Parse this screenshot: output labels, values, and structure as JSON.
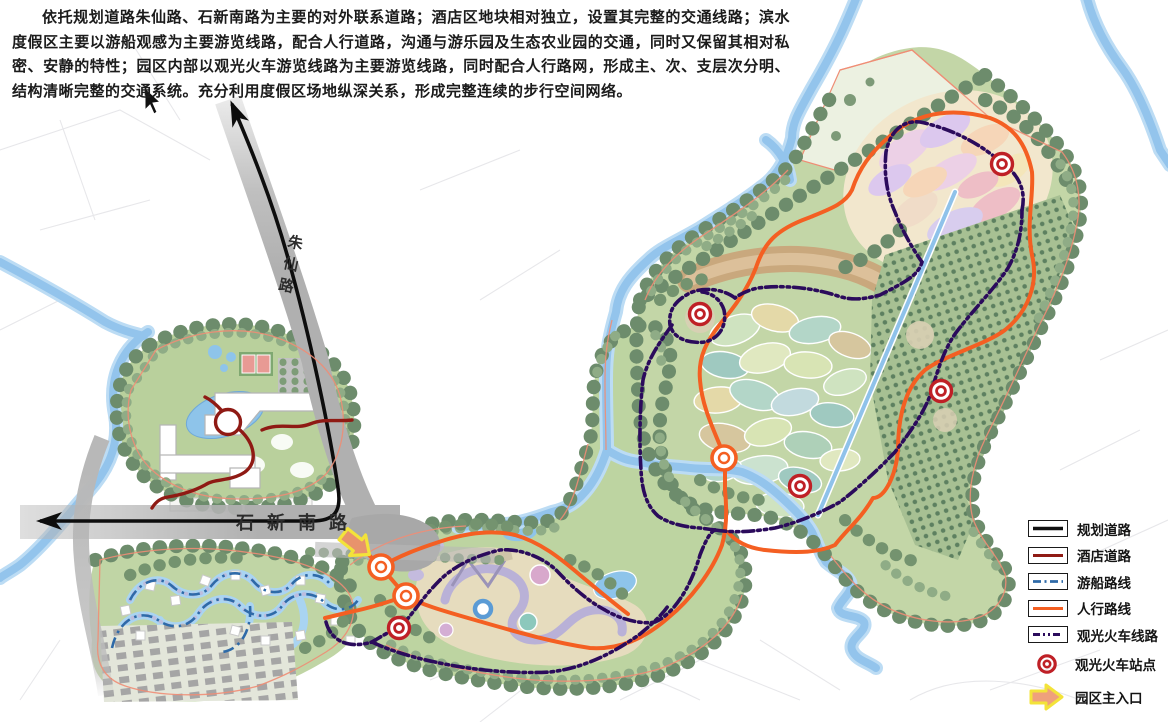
{
  "description": {
    "text": "依托规划道路朱仙路、石新南路为主要的对外联系道路；酒店区地块相对独立，设置其完整的交通线路；滨水度假区主要以游船观感为主要游览线路，配合人行道路，沟通与游乐园及生态农业园的交通，同时又保留其相对私密、安静的特性；园区内部以观光火车游览线路为主要游览线路，同时配合人行路网，形成主、次、支层次分明、结构清晰完整的交通系统。充分利用度假区场地纵深关系，形成完整连续的步行空间网络。"
  },
  "map": {
    "road_labels": {
      "zhuxian": "朱仙路",
      "shixin": "石新南路"
    },
    "train_stations": [
      [
        1002,
        164
      ],
      [
        700,
        314
      ],
      [
        941,
        391
      ],
      [
        800,
        486
      ],
      [
        399,
        628
      ]
    ],
    "pedestrian_nodes": [
      [
        381,
        567
      ],
      [
        406,
        596
      ],
      [
        724,
        458
      ]
    ],
    "main_entrance": [
      356,
      544
    ]
  },
  "legend": {
    "items": [
      {
        "label": "规划道路",
        "color": "#111111",
        "style": "solid"
      },
      {
        "label": "酒店道路",
        "color": "#8f1a14",
        "style": "solid"
      },
      {
        "label": "游船路线",
        "color": "#2e6aa8",
        "style": "dashdot"
      },
      {
        "label": "人行路线",
        "color": "#f45f22",
        "style": "solid"
      },
      {
        "label": "观光火车线路",
        "color": "#2b0b5c",
        "style": "dashdot"
      },
      {
        "label": "观光火车站点",
        "color": "#bf2026",
        "style": "station"
      },
      {
        "label": "园区主入口",
        "color": "#efa07c",
        "style": "arrow",
        "border": "#f3e33a"
      }
    ]
  },
  "colors": {
    "planning_road": "#111111",
    "hotel_road": "#8f1a14",
    "boat_route": "#2e6aa8",
    "pedestrian_route": "#f45f22",
    "train_route": "#2b0b5c",
    "station": "#bf2026",
    "entrance_fill": "#efa07c",
    "entrance_border": "#f3e33a",
    "river": "#93c4ec",
    "park_green": "#bdd3a0",
    "road_gray": "#b3b3b3"
  }
}
